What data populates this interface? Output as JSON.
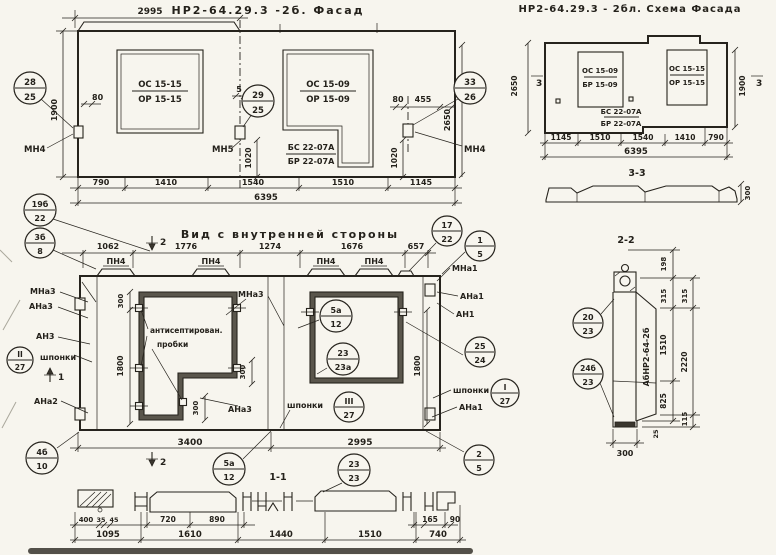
{
  "colors": {
    "ink": "#26231d",
    "paper": "#f7f5ee"
  },
  "facade": {
    "title": "НР2-64.29.3 -2б. Фасад",
    "dim_top": "2995",
    "window1": {
      "top": "ОС 15-15",
      "bot": "ОР 15-15"
    },
    "window2": {
      "top": "ОС 15-09",
      "bot": "ОР 15-09"
    },
    "block": {
      "top": "БС 22-07А",
      "bot": "БР 22-07А"
    },
    "anchor_left": "МН4",
    "anchor_mid": "МН5",
    "anchor_right": "МН4",
    "d80_left": "80",
    "d1900": "1900",
    "d5": "5",
    "d80_mid": "80",
    "d80_right": "80",
    "d455": "455",
    "d1020_left": "1020",
    "d1020_right": "1020",
    "d2650": "2650",
    "dims_bottom": [
      "790",
      "1410",
      "1540",
      "1510",
      "1145"
    ],
    "dim_total": "6395",
    "callouts": {
      "c28": {
        "top": "28",
        "bot": "25"
      },
      "c29": {
        "top": "29",
        "bot": "25"
      },
      "c33": {
        "top": "33",
        "bot": "26"
      }
    }
  },
  "scheme": {
    "title": "НР2-64.29.3 - 2бл. Схема Фасада",
    "window1": {
      "top": "ОС 15-09",
      "bot": "БР 15-09"
    },
    "window2": {
      "top": "ОС 15-15",
      "bot": "ОР 15-15"
    },
    "block": {
      "top": "БС 22-07А",
      "bot": "БР 22-07А"
    },
    "d2650": "2650",
    "d1900": "1900",
    "marker_left": "3",
    "marker_right": "3",
    "dims_bottom": [
      "1145",
      "1510",
      "1540",
      "1410",
      "790"
    ],
    "dim_total": "6395",
    "section_label": "3-3",
    "d300": "300"
  },
  "inner": {
    "title": "Вид с внутренней стороны",
    "dims_top": [
      "1062",
      "1776",
      "1274",
      "1676",
      "657"
    ],
    "pn4": "ПН4",
    "note": {
      "line1": "антисептирован.",
      "line2": "пробки"
    },
    "shponki": "шпонки",
    "labels": {
      "mna3_left": "МНа3",
      "ana3_left": "АНа3",
      "an3": "АН3",
      "ana2": "АНа2",
      "mna3_mid": "МНа3",
      "ana3_mid": "АНа3",
      "mna1": "МНа1",
      "ana1_top": "АНа1",
      "an1": "АН1",
      "ana1_bot": "АНа1"
    },
    "d300_top": "300",
    "d1800_left": "1800",
    "d300_step": "300",
    "d300_bot": "300",
    "d1800_right": "1800",
    "d3400": "3400",
    "d2995": "2995",
    "m1": "1",
    "m2_top": "2",
    "m2_bot": "2",
    "callouts": {
      "c19b": {
        "top": "19б",
        "bot": "22"
      },
      "c3b": {
        "top": "3б",
        "bot": "8"
      },
      "c17": {
        "top": "17",
        "bot": "22"
      },
      "c1": {
        "top": "1",
        "bot": "5"
      },
      "c5a": {
        "top": "5а",
        "bot": "12"
      },
      "c23a": {
        "top": "23",
        "bot": "23а"
      },
      "c3_27": {
        "top": "III",
        "bot": "27"
      },
      "c2_27": {
        "top": "II",
        "bot": "27"
      },
      "c1_27": {
        "top": "I",
        "bot": "27"
      },
      "c25": {
        "top": "25",
        "bot": "24"
      },
      "c4b": {
        "top": "4б",
        "bot": "10"
      },
      "c5a2": {
        "top": "5а",
        "bot": "12"
      },
      "c23": {
        "top": "23",
        "bot": "23"
      },
      "c2": {
        "top": "2",
        "bot": "5"
      }
    }
  },
  "s11": {
    "title": "1-1",
    "row1": [
      "400",
      "35",
      "45",
      "720",
      "890",
      "165",
      "90"
    ],
    "row2": [
      "1095",
      "1610",
      "1440",
      "1510",
      "740"
    ]
  },
  "s22": {
    "title": "2-2",
    "mark": "АбНР2-64-2б",
    "d198": "198",
    "d315_a": "315",
    "d315_b": "315",
    "d1510": "1510",
    "d2220": "2220",
    "d825": "825",
    "d115": "115",
    "d25": "25",
    "d300": "300",
    "callouts": {
      "c20": {
        "top": "20",
        "bot": "23"
      },
      "c24b": {
        "top": "24б",
        "bot": "23"
      }
    }
  }
}
